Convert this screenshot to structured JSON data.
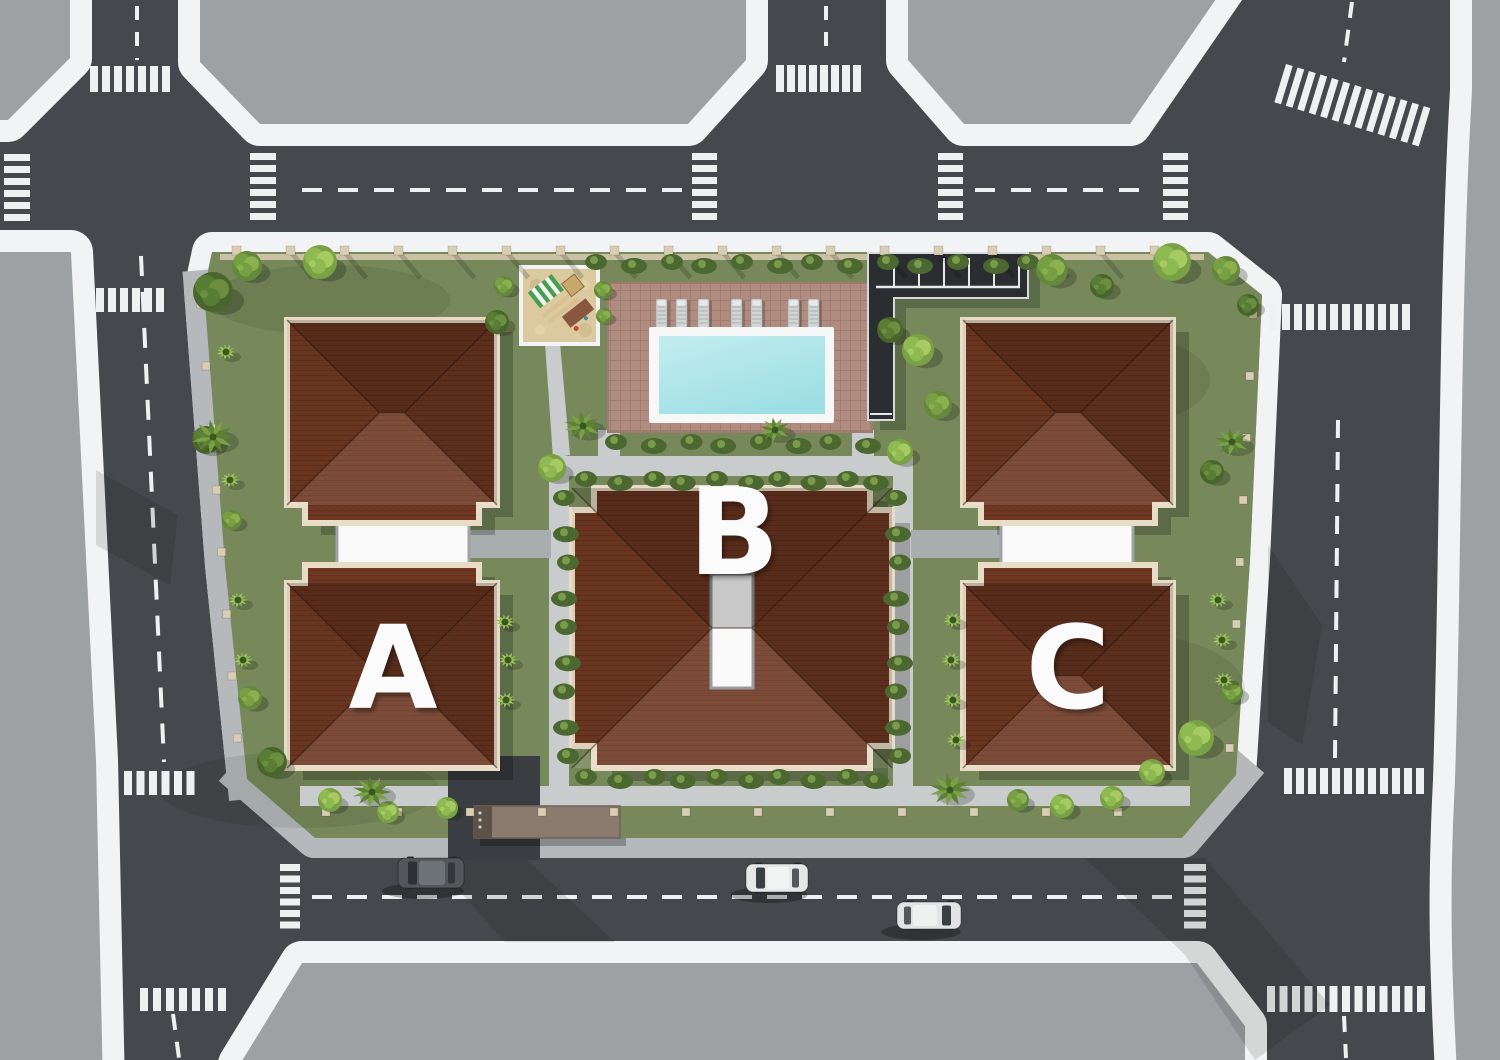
{
  "buildings": [
    {
      "id": "building-a",
      "label": "A"
    },
    {
      "id": "building-b",
      "label": "B"
    },
    {
      "id": "building-c",
      "label": "C"
    }
  ],
  "site_features": {
    "swimming_pools": 1,
    "playgrounds": 1,
    "parking_areas": 1,
    "entrance_canopies": 1,
    "sun_loungers": 7,
    "cars_on_road": 3
  },
  "palette": {
    "background_gray": "#9EA1A4",
    "asphalt": "#45484D",
    "sidewalk": "#F2F3F4",
    "paver": "#B5B9BB",
    "grass": "#77895B",
    "path": "#C9CCCD",
    "path_dark": "#A8ADAF",
    "roof": "#6E3823",
    "roof_light": "#7C4128",
    "roof_dark": "#5A2A1B",
    "roof_trim": "#E8DCC6",
    "wall_white": "#FAFAFA",
    "pool_water": "#9FDFE4",
    "pool_water_light": "#C2EDEF",
    "pool_coping": "#F6F7F7",
    "deck": "#B08C80",
    "sand": "#DBC99F",
    "parking_dark": "#2B2E31",
    "canopy_brown": "#8B7B6E",
    "hedge": "#4C6831",
    "bush": "#7FA848",
    "tree_dark": "#48662B",
    "palm": "#5E8233",
    "post_beige": "#D9CDB4",
    "marking_white": "#EEF0F1",
    "car_dark": "#53575B",
    "car_light": "#E6E8E8",
    "label_white": "#FBFBFB"
  }
}
